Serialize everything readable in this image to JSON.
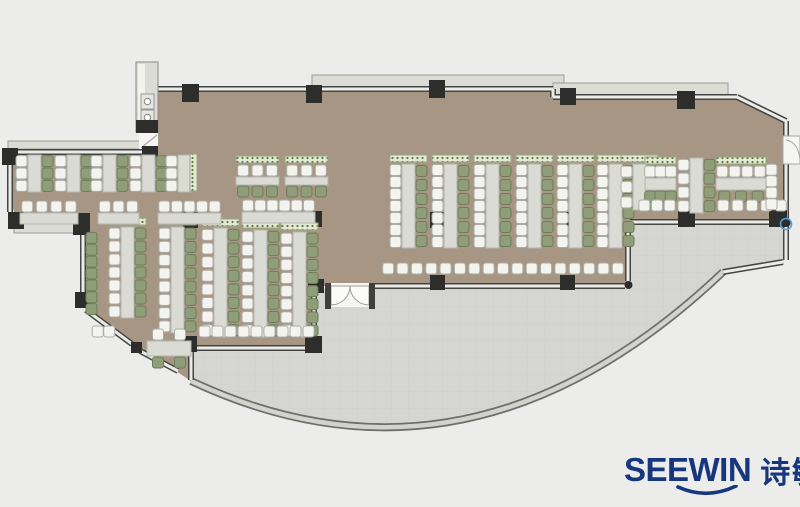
{
  "logo": {
    "brand": "SEEWIN",
    "brand_cn": "诗敏",
    "color": "#16367d"
  },
  "palette": {
    "background": "#ececea",
    "floor_carpet": "#a5927e",
    "terrace": "#d5d5d2",
    "exterior_ledge": "#dcdcd6",
    "wall_dark": "#454543",
    "wall_light": "#ebebe8",
    "column": "#2d2d2b",
    "desk": "#dbdbd5",
    "chair_white": "#f3f3f0",
    "chair_green": "#8f9d79",
    "planter": "#e4e9d7",
    "planter_dot": "#557f33",
    "marker_blue": "#5b9bd5"
  },
  "furniture": {
    "benches_v": [
      {
        "x": 28,
        "y1": 155,
        "y2": 192,
        "left": 3,
        "right": 3,
        "planter": false
      },
      {
        "x": 67,
        "y1": 155,
        "y2": 192,
        "left": 3,
        "right": 3,
        "planter": false
      },
      {
        "x": 103,
        "y1": 155,
        "y2": 192,
        "left": 3,
        "right": 3,
        "planter": false
      },
      {
        "x": 142,
        "y1": 155,
        "y2": 192,
        "left": 3,
        "right": 3,
        "planter": false
      },
      {
        "x": 178,
        "y1": 155,
        "y2": 192,
        "left": 3,
        "right": 0,
        "planter": false
      },
      {
        "x": 402,
        "y1": 164,
        "y2": 248,
        "left": 7,
        "right": 6,
        "planter": true
      },
      {
        "x": 444,
        "y1": 164,
        "y2": 248,
        "left": 7,
        "right": 6,
        "planter": true
      },
      {
        "x": 486,
        "y1": 164,
        "y2": 248,
        "left": 7,
        "right": 6,
        "planter": true
      },
      {
        "x": 528,
        "y1": 164,
        "y2": 248,
        "left": 7,
        "right": 6,
        "planter": true
      },
      {
        "x": 569,
        "y1": 164,
        "y2": 248,
        "left": 7,
        "right": 6,
        "planter": true
      },
      {
        "x": 609,
        "y1": 164,
        "y2": 248,
        "left": 7,
        "right": 6,
        "planter": true
      },
      {
        "x": 633,
        "y1": 164,
        "y2": 210,
        "left": 3,
        "right": 3,
        "planter": true
      },
      {
        "x": 121,
        "y1": 227,
        "y2": 318,
        "left": 7,
        "right": 7,
        "planter": true
      },
      {
        "x": 171,
        "y1": 227,
        "y2": 333,
        "left": 8,
        "right": 8,
        "planter": true
      },
      {
        "x": 214,
        "y1": 228,
        "y2": 337,
        "left": 8,
        "right": 8,
        "planter": true
      },
      {
        "x": 254,
        "y1": 230,
        "y2": 337,
        "left": 8,
        "right": 8,
        "planter": true
      },
      {
        "x": 293,
        "y1": 232,
        "y2": 337,
        "left": 8,
        "right": 8,
        "planter": true
      },
      {
        "x": 690,
        "y1": 158,
        "y2": 213,
        "left": 4,
        "right": 4,
        "planter": false
      }
    ],
    "benches_h": [
      {
        "x1": 236,
        "x2": 279,
        "desk_y": 177,
        "h": 8,
        "top": 3,
        "bottom": 3,
        "planter": true
      },
      {
        "x1": 285,
        "x2": 328,
        "desk_y": 177,
        "h": 8,
        "top": 3,
        "bottom": 3,
        "planter": true
      },
      {
        "x1": 20,
        "x2": 78,
        "desk_y": 213,
        "h": 11,
        "top": 4,
        "bottom": 0,
        "planter": false
      },
      {
        "x1": 98,
        "x2": 139,
        "desk_y": 213,
        "h": 11,
        "top": 3,
        "bottom": 0,
        "planter": false
      },
      {
        "x1": 158,
        "x2": 221,
        "desk_y": 213,
        "h": 11,
        "top": 5,
        "bottom": 0,
        "planter": false
      },
      {
        "x1": 242,
        "x2": 315,
        "desk_y": 212,
        "h": 11,
        "top": 6,
        "bottom": 0,
        "planter": false
      },
      {
        "x1": 645,
        "x2": 676,
        "desk_y": 178,
        "h": 12,
        "top": 3,
        "bottom": 3,
        "planter": true
      },
      {
        "x1": 716,
        "x2": 766,
        "desk_y": 178,
        "h": 12,
        "top": 4,
        "bottom": 3,
        "planter": true
      },
      {
        "x1": 147,
        "x2": 191,
        "desk_y": 341,
        "h": 15,
        "top": 2,
        "bottom": 2,
        "planter": false
      }
    ],
    "chair_rows": [
      {
        "x1": 381,
        "x2": 625,
        "y": 263,
        "n": 17,
        "c": "white"
      },
      {
        "x1": 198,
        "x2": 315,
        "y": 326,
        "n": 9,
        "c": "white"
      },
      {
        "x1": 638,
        "x2": 676,
        "y": 200,
        "n": 3,
        "c": "white"
      },
      {
        "x1": 716,
        "x2": 788,
        "y": 200,
        "n": 5,
        "c": "white"
      },
      {
        "x1": 92,
        "x2": 115,
        "y": 326,
        "n": 2,
        "c": "white"
      }
    ],
    "chair_cols": [
      {
        "x": 86,
        "y1": 232,
        "y2": 315,
        "n": 7,
        "c": "green"
      },
      {
        "x": 766,
        "y1": 164,
        "y2": 210,
        "n": 4,
        "c": "white"
      }
    ],
    "planters": [
      {
        "x": 190,
        "y": 154,
        "w": 7,
        "h": 37
      }
    ],
    "markers": [
      {
        "type": "circle",
        "x": 786,
        "y": 224,
        "r": 5.5
      }
    ]
  }
}
